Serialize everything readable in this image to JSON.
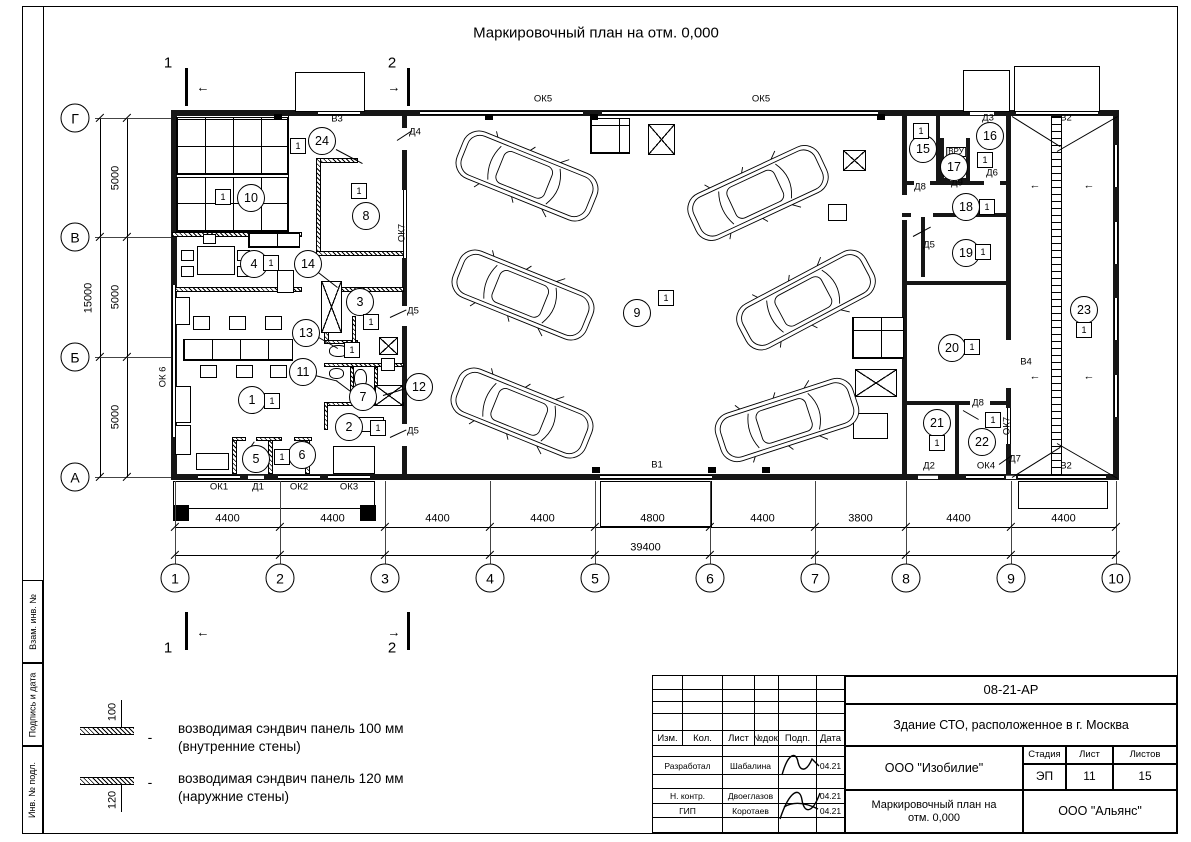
{
  "page_title": "Маркировочный план на отм. 0,000",
  "frame_strips": [
    "Взам. инв. №",
    "Подпись и дата",
    "Инв. № подл."
  ],
  "legend": {
    "items": [
      {
        "dim": "100",
        "dash": "-",
        "line1": "возводимая сэндвич панель 100 мм",
        "line2": "(внутренние стены)"
      },
      {
        "dim": "120",
        "dash": "-",
        "line1": "возводимая сэндвич панель 120 мм",
        "line2": "(наружние стены)"
      }
    ]
  },
  "titleblock": {
    "doc_number": "08-21-АР",
    "project": "Здание СТО, расположенное в г. Москва",
    "columns": [
      "Изм.",
      "Кол.",
      "Лист",
      "№док.",
      "Подп.",
      "Дата"
    ],
    "rows": [
      {
        "role": "Разработал",
        "name": "Шабалина",
        "date": "04.21"
      },
      {
        "role": "Н. контр.",
        "name": "Двоеглазов",
        "date": "04.21"
      },
      {
        "role": "ГИП",
        "name": "Коротаев",
        "date": "04.21"
      }
    ],
    "company": "ООО \"Изобилие\"",
    "stage_label": "Стадия",
    "stage": "ЭП",
    "sheet_label": "Лист",
    "sheet": "11",
    "sheets_label": "Листов",
    "sheets": "15",
    "drawing_name": "Маркировочный план на отм. 0,000",
    "contractor": "ООО \"Альянс\""
  },
  "plan": {
    "tag_text": "1",
    "axes": {
      "cols": [
        [
          "1",
          175
        ],
        [
          "2",
          280
        ],
        [
          "3",
          385
        ],
        [
          "4",
          490
        ],
        [
          "5",
          595
        ],
        [
          "6",
          710
        ],
        [
          "7",
          815
        ],
        [
          "8",
          906
        ],
        [
          "9",
          1011
        ],
        [
          "10",
          1116
        ]
      ],
      "rows": [
        [
          "Г",
          118
        ],
        [
          "В",
          237
        ],
        [
          "Б",
          357
        ],
        [
          "А",
          477
        ]
      ]
    },
    "dims": {
      "bottom": [
        "4400",
        "4400",
        "4400",
        "4400",
        "4800",
        "4400",
        "3800",
        "4400",
        "4400"
      ],
      "left": [
        "5000",
        "5000",
        "5000"
      ],
      "total_bottom": "39400",
      "total_left": "15000"
    },
    "walls": [
      [
        171,
        110,
        948,
        6,
        "o"
      ],
      [
        171,
        474,
        948,
        6,
        "o"
      ],
      [
        171,
        110,
        6,
        370,
        "o"
      ],
      [
        1113,
        110,
        6,
        370,
        "o"
      ],
      [
        402,
        116,
        5,
        12,
        "o"
      ],
      [
        402,
        150,
        5,
        40,
        "o"
      ],
      [
        402,
        258,
        5,
        48,
        "o"
      ],
      [
        402,
        326,
        5,
        98,
        "o"
      ],
      [
        402,
        446,
        5,
        28,
        "o"
      ],
      [
        902,
        116,
        5,
        79,
        "o"
      ],
      [
        902,
        220,
        5,
        254,
        "o"
      ],
      [
        1006,
        116,
        5,
        224,
        "o"
      ],
      [
        1006,
        388,
        5,
        20,
        "o"
      ],
      [
        1006,
        444,
        5,
        30,
        "o"
      ],
      [
        936,
        116,
        4,
        67,
        "o"
      ],
      [
        940,
        138,
        4,
        44,
        "o"
      ],
      [
        966,
        138,
        4,
        44,
        "o"
      ],
      [
        940,
        178,
        10,
        4,
        "o"
      ],
      [
        958,
        178,
        12,
        4,
        "o"
      ],
      [
        902,
        181,
        12,
        4,
        "o"
      ],
      [
        930,
        181,
        10,
        4,
        "o"
      ],
      [
        940,
        181,
        44,
        4,
        "o"
      ],
      [
        1000,
        181,
        11,
        4,
        "o"
      ],
      [
        902,
        213,
        9,
        4,
        "o"
      ],
      [
        933,
        213,
        78,
        4,
        "o"
      ],
      [
        921,
        217,
        4,
        60,
        "o"
      ],
      [
        902,
        281,
        109,
        4,
        "o"
      ],
      [
        902,
        401,
        68,
        4,
        "o"
      ],
      [
        990,
        401,
        21,
        4,
        "o"
      ],
      [
        955,
        405,
        4,
        69,
        "o"
      ],
      [
        172,
        232,
        130,
        5,
        "h"
      ],
      [
        316,
        158,
        42,
        5,
        "h"
      ],
      [
        316,
        158,
        5,
        98,
        "h"
      ],
      [
        316,
        251,
        90,
        5,
        "h"
      ],
      [
        172,
        287,
        130,
        5,
        "h"
      ],
      [
        324,
        287,
        80,
        5,
        "h"
      ],
      [
        324,
        292,
        5,
        51,
        "h"
      ],
      [
        324,
        340,
        34,
        4,
        "h"
      ],
      [
        352,
        316,
        4,
        28,
        "h"
      ],
      [
        324,
        363,
        80,
        4,
        "h"
      ],
      [
        350,
        367,
        4,
        38,
        "h"
      ],
      [
        324,
        402,
        80,
        4,
        "h"
      ],
      [
        324,
        402,
        4,
        28,
        "h"
      ],
      [
        374,
        367,
        4,
        39,
        "h"
      ],
      [
        232,
        437,
        5,
        37,
        "h"
      ],
      [
        268,
        437,
        5,
        37,
        "h"
      ],
      [
        305,
        437,
        5,
        37,
        "h"
      ],
      [
        232,
        437,
        14,
        4,
        "h"
      ],
      [
        256,
        437,
        26,
        4,
        "h"
      ],
      [
        294,
        437,
        18,
        4,
        "h"
      ],
      [
        288,
        116,
        1,
        116,
        "t"
      ]
    ],
    "openings": [
      [
        420,
        111,
        163,
        4,
        "wh"
      ],
      [
        602,
        111,
        276,
        4,
        "wh"
      ],
      [
        318,
        111,
        42,
        4,
        "wh"
      ],
      [
        970,
        111,
        24,
        4,
        "dh"
      ],
      [
        1016,
        111,
        82,
        4,
        "wh"
      ],
      [
        198,
        475,
        42,
        4,
        "wh"
      ],
      [
        248,
        475,
        16,
        4,
        "dh"
      ],
      [
        278,
        475,
        42,
        4,
        "wh"
      ],
      [
        328,
        475,
        42,
        4,
        "wh"
      ],
      [
        600,
        475,
        112,
        4,
        "wh"
      ],
      [
        918,
        475,
        20,
        4,
        "dh"
      ],
      [
        966,
        475,
        38,
        4,
        "wh"
      ],
      [
        1006,
        475,
        10,
        4,
        "dh"
      ],
      [
        1018,
        475,
        88,
        4,
        "wh"
      ],
      [
        172,
        285,
        4,
        152,
        "wv"
      ],
      [
        1114,
        145,
        4,
        42,
        "wv"
      ],
      [
        1114,
        222,
        4,
        42,
        "wv"
      ],
      [
        1114,
        298,
        4,
        42,
        "wv"
      ],
      [
        1114,
        375,
        4,
        42,
        "wv"
      ],
      [
        403,
        190,
        4,
        68,
        "wv"
      ],
      [
        1007,
        408,
        4,
        36,
        "wv"
      ]
    ],
    "furniture": [
      [
        176,
        117,
        112,
        58,
        "shelf"
      ],
      [
        176,
        177,
        112,
        55,
        "shelf"
      ],
      [
        248,
        233,
        52,
        15,
        "shelf"
      ],
      [
        197,
        246,
        38,
        29,
        "box"
      ],
      [
        181,
        250,
        13,
        11,
        "box"
      ],
      [
        181,
        266,
        13,
        11,
        "box"
      ],
      [
        237,
        250,
        13,
        11,
        "box"
      ],
      [
        237,
        266,
        13,
        11,
        "box"
      ],
      [
        203,
        234,
        13,
        10,
        "box"
      ],
      [
        277,
        270,
        17,
        23,
        "box"
      ],
      [
        183,
        339,
        110,
        22,
        "shelf"
      ],
      [
        193,
        316,
        17,
        14,
        "box"
      ],
      [
        229,
        316,
        17,
        14,
        "box"
      ],
      [
        265,
        316,
        17,
        14,
        "box"
      ],
      [
        200,
        365,
        17,
        13,
        "box"
      ],
      [
        236,
        365,
        17,
        13,
        "box"
      ],
      [
        270,
        365,
        17,
        13,
        "box"
      ],
      [
        175,
        297,
        15,
        28,
        "box"
      ],
      [
        175,
        386,
        16,
        37,
        "box"
      ],
      [
        175,
        425,
        16,
        30,
        "box"
      ],
      [
        196,
        453,
        33,
        17,
        "box"
      ],
      [
        321,
        281,
        21,
        52,
        "xbox"
      ],
      [
        329,
        345,
        19,
        12,
        "wc"
      ],
      [
        329,
        368,
        15,
        11,
        "wc"
      ],
      [
        354,
        369,
        13,
        19,
        "wc"
      ],
      [
        379,
        337,
        19,
        18,
        "xbox"
      ],
      [
        381,
        358,
        14,
        13,
        "box"
      ],
      [
        375,
        385,
        28,
        21,
        "xbox"
      ],
      [
        358,
        417,
        26,
        15,
        "box"
      ],
      [
        333,
        446,
        42,
        28,
        "box"
      ],
      [
        590,
        118,
        40,
        36,
        "shelf"
      ],
      [
        648,
        124,
        27,
        31,
        "xbox"
      ],
      [
        843,
        150,
        23,
        21,
        "xbox"
      ],
      [
        828,
        204,
        19,
        17,
        "box"
      ],
      [
        852,
        317,
        52,
        42,
        "shelf"
      ],
      [
        855,
        369,
        42,
        28,
        "xbox"
      ],
      [
        853,
        413,
        35,
        26,
        "box"
      ],
      [
        1051,
        116,
        11,
        360,
        "ladder"
      ],
      [
        295,
        72,
        70,
        40,
        "box"
      ],
      [
        963,
        70,
        47,
        42,
        "box"
      ],
      [
        1014,
        66,
        86,
        46,
        "box"
      ],
      [
        173,
        481,
        202,
        28,
        "box"
      ],
      [
        600,
        481,
        112,
        46,
        "box"
      ],
      [
        1018,
        481,
        90,
        28,
        "box"
      ],
      [
        173,
        505,
        16,
        16,
        "bar"
      ],
      [
        360,
        505,
        16,
        16,
        "bar"
      ],
      [
        185,
        68,
        3,
        38,
        "bar"
      ],
      [
        407,
        68,
        3,
        38,
        "bar"
      ],
      [
        185,
        612,
        3,
        38,
        "bar"
      ],
      [
        407,
        612,
        3,
        38,
        "bar"
      ],
      [
        274,
        114,
        8,
        6,
        "bar"
      ],
      [
        485,
        114,
        8,
        6,
        "bar"
      ],
      [
        590,
        114,
        8,
        6,
        "bar"
      ],
      [
        877,
        114,
        8,
        6,
        "bar"
      ],
      [
        592,
        467,
        8,
        6,
        "bar"
      ],
      [
        708,
        467,
        8,
        6,
        "bar"
      ],
      [
        762,
        467,
        8,
        6,
        "bar"
      ]
    ],
    "lines": [
      [
        336,
        149,
        30,
        28
      ],
      [
        317,
        271,
        26,
        38
      ],
      [
        317,
        336,
        24,
        30
      ],
      [
        315,
        375,
        23,
        14
      ],
      [
        383,
        395,
        24,
        -17
      ],
      [
        336,
        380,
        21,
        37
      ],
      [
        397,
        140,
        18,
        -33
      ],
      [
        390,
        317,
        18,
        -25
      ],
      [
        390,
        437,
        18,
        -25
      ],
      [
        913,
        236,
        20,
        -28
      ],
      [
        963,
        410,
        18,
        30
      ],
      [
        999,
        464,
        16,
        -35
      ],
      [
        244,
        456,
        18,
        -55
      ],
      [
        288,
        456,
        18,
        -55
      ],
      [
        1012,
        116,
        57,
        32
      ],
      [
        1057,
        151,
        70,
        -30
      ],
      [
        1012,
        477,
        57,
        -32
      ],
      [
        1057,
        443,
        70,
        30
      ]
    ],
    "labels": [
      [
        "ОК5",
        543,
        99,
        0,
        0,
        0
      ],
      [
        "ОК5",
        761,
        99,
        0,
        0,
        0
      ],
      [
        "В3",
        337,
        119,
        0,
        0,
        0
      ],
      [
        "Д4",
        415,
        132,
        0,
        0,
        0
      ],
      [
        "ОК7",
        402,
        233,
        -90,
        0,
        0
      ],
      [
        "Д5",
        413,
        311,
        0,
        0,
        0
      ],
      [
        "Д5",
        413,
        431,
        0,
        0,
        0
      ],
      [
        "ОК 6",
        163,
        377,
        -90,
        0,
        0
      ],
      [
        "ОК1",
        219,
        487,
        0,
        0,
        0
      ],
      [
        "Д1",
        258,
        487,
        0,
        0,
        0
      ],
      [
        "ОК2",
        299,
        487,
        0,
        0,
        0
      ],
      [
        "ОК3",
        349,
        487,
        0,
        0,
        0
      ],
      [
        "В1",
        657,
        465,
        0,
        0,
        0
      ],
      [
        "Д3",
        988,
        118,
        0,
        0,
        0
      ],
      [
        "В2",
        1066,
        118,
        0,
        0,
        0
      ],
      [
        "Д8",
        920,
        187,
        0,
        0,
        0
      ],
      [
        "Д9",
        957,
        183,
        0,
        0,
        0
      ],
      [
        "Д6",
        992,
        173,
        0,
        0,
        0
      ],
      [
        "ВРУ",
        956,
        152,
        0,
        0,
        1
      ],
      [
        "Д5",
        929,
        245,
        0,
        0,
        0
      ],
      [
        "В4",
        1026,
        362,
        0,
        0,
        0
      ],
      [
        "Д8",
        978,
        403,
        0,
        0,
        0
      ],
      [
        "ОК7",
        1007,
        426,
        -90,
        0,
        0
      ],
      [
        "Д7",
        1015,
        459,
        0,
        0,
        0
      ],
      [
        "Д2",
        929,
        466,
        0,
        0,
        0
      ],
      [
        "ОК4",
        986,
        466,
        0,
        0,
        0
      ],
      [
        "В2",
        1066,
        466,
        0,
        0,
        0
      ],
      [
        "1",
        168,
        63,
        0,
        15,
        0
      ],
      [
        "2",
        392,
        63,
        0,
        15,
        0
      ],
      [
        "1",
        168,
        648,
        0,
        15,
        0
      ],
      [
        "2",
        392,
        648,
        0,
        15,
        0
      ],
      [
        "←",
        203,
        87,
        0,
        13,
        0
      ],
      [
        "→",
        394,
        87,
        0,
        13,
        0
      ],
      [
        "←",
        203,
        632,
        0,
        13,
        0
      ],
      [
        "→",
        394,
        632,
        0,
        13,
        0
      ],
      [
        "←",
        1035,
        186,
        0,
        11,
        0
      ],
      [
        "←",
        1089,
        186,
        0,
        11,
        0
      ],
      [
        "←",
        1035,
        377,
        0,
        11,
        0
      ],
      [
        "←",
        1089,
        377,
        0,
        11,
        0
      ]
    ],
    "rooms": [
      [
        "1",
        252,
        400
      ],
      [
        "2",
        349,
        427
      ],
      [
        "3",
        360,
        302
      ],
      [
        "4",
        254,
        264
      ],
      [
        "5",
        256,
        459
      ],
      [
        "6",
        302,
        455
      ],
      [
        "7",
        363,
        397
      ],
      [
        "8",
        366,
        216
      ],
      [
        "9",
        637,
        313
      ],
      [
        "10",
        251,
        198
      ],
      [
        "11",
        303,
        372
      ],
      [
        "12",
        419,
        387
      ],
      [
        "13",
        306,
        333
      ],
      [
        "14",
        308,
        264
      ],
      [
        "15",
        923,
        149
      ],
      [
        "16",
        990,
        136
      ],
      [
        "17",
        954,
        167
      ],
      [
        "18",
        966,
        207
      ],
      [
        "19",
        966,
        253
      ],
      [
        "20",
        952,
        348
      ],
      [
        "21",
        937,
        423
      ],
      [
        "22",
        982,
        442
      ],
      [
        "23",
        1084,
        310
      ],
      [
        "24",
        322,
        141
      ]
    ],
    "tags": [
      [
        272,
        401
      ],
      [
        378,
        428
      ],
      [
        371,
        322
      ],
      [
        271,
        263
      ],
      [
        282,
        457
      ],
      [
        352,
        350
      ],
      [
        359,
        191
      ],
      [
        666,
        298
      ],
      [
        223,
        197
      ],
      [
        298,
        146
      ],
      [
        921,
        131
      ],
      [
        985,
        160
      ],
      [
        987,
        207
      ],
      [
        983,
        252
      ],
      [
        972,
        347
      ],
      [
        937,
        443
      ],
      [
        993,
        420
      ],
      [
        1084,
        330
      ]
    ],
    "cars": [
      [
        527,
        176,
        22
      ],
      [
        523,
        295,
        22
      ],
      [
        522,
        413,
        22
      ],
      [
        758,
        193,
        -25
      ],
      [
        806,
        300,
        -28
      ],
      [
        787,
        420,
        -18
      ]
    ]
  }
}
